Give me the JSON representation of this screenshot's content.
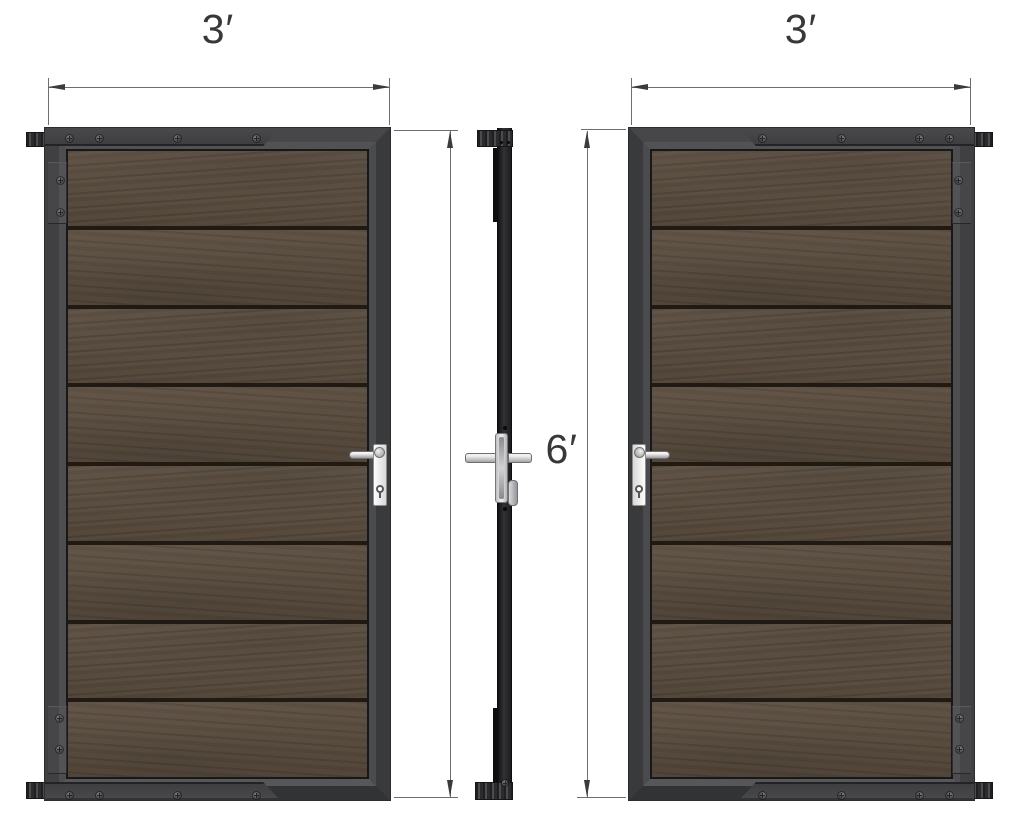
{
  "diagram": {
    "type": "technical-drawing",
    "dimensions": {
      "left_width": "3′",
      "right_width": "3′",
      "height": "6′"
    },
    "views": [
      {
        "name": "front-left",
        "width_label": "3′",
        "planks": 8
      },
      {
        "name": "side-profile"
      },
      {
        "name": "front-right",
        "width_label": "3′",
        "planks": 8
      }
    ],
    "colors": {
      "background": "#ffffff",
      "frame_face": "#3a3a3c",
      "frame_bevel": "#4e4e51",
      "plank": "#584a3c",
      "plank_seam": "#201a13",
      "hardware_silver": "#d6d6d6",
      "dimension_line": "#6e6e6e",
      "label_text": "#383838"
    }
  }
}
